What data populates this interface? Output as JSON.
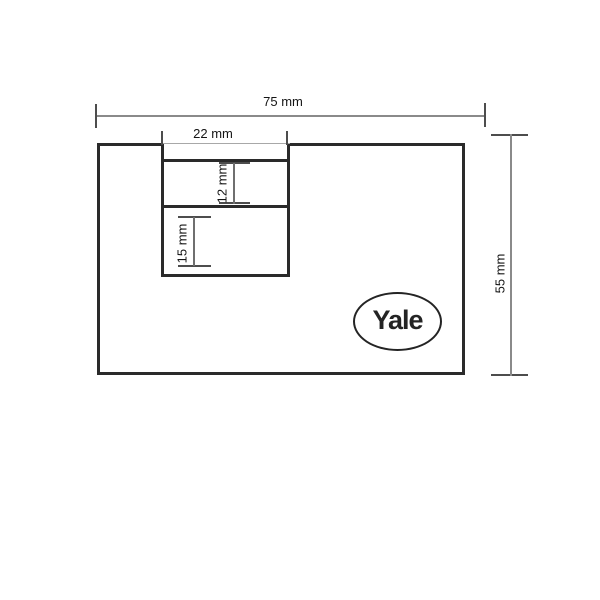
{
  "diagram": {
    "labels": {
      "overall_width": "75 mm",
      "slot_width": "22 mm",
      "slot_upper_height": "12 mm",
      "slot_lower_height": "15 mm",
      "overall_height": "55 mm"
    },
    "logo": {
      "text": "Yale"
    },
    "colors": {
      "outline": "#2a2a2a",
      "dimension_line": "#8a8a8a",
      "dimension_tick": "#4d4d4d",
      "label_text": "#141414",
      "background": "#ffffff"
    }
  }
}
